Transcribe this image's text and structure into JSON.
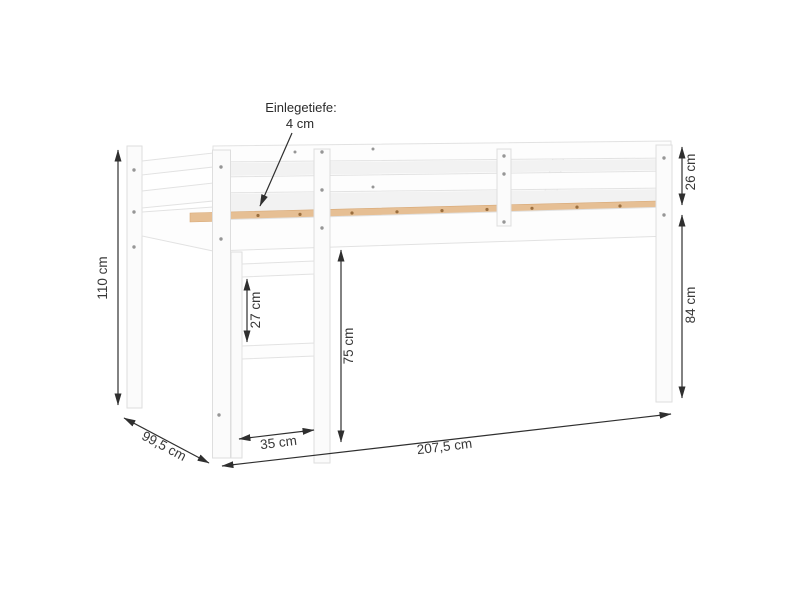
{
  "diagram": {
    "title": "Loft bed dimension diagram",
    "subject": "white loft bed with front ladder, perspective line drawing",
    "callout": {
      "line1": "Einlegetiefe:",
      "line2": "4 cm"
    },
    "dimensions": {
      "total_height": "110 cm",
      "depth": "99,5 cm",
      "ladder_width": "35 cm",
      "length": "207,5 cm",
      "rung_spacing": "27 cm",
      "under_bed_clearance": "75 cm",
      "guard_rail_height": "26 cm",
      "leg_height": "84 cm"
    },
    "colors": {
      "background": "#ffffff",
      "bed_fill": "#fdfdfd",
      "bed_stroke": "#e2e2e2",
      "slat_wood": "#e6bf94",
      "dimension_ink": "#2f2f2f"
    }
  }
}
